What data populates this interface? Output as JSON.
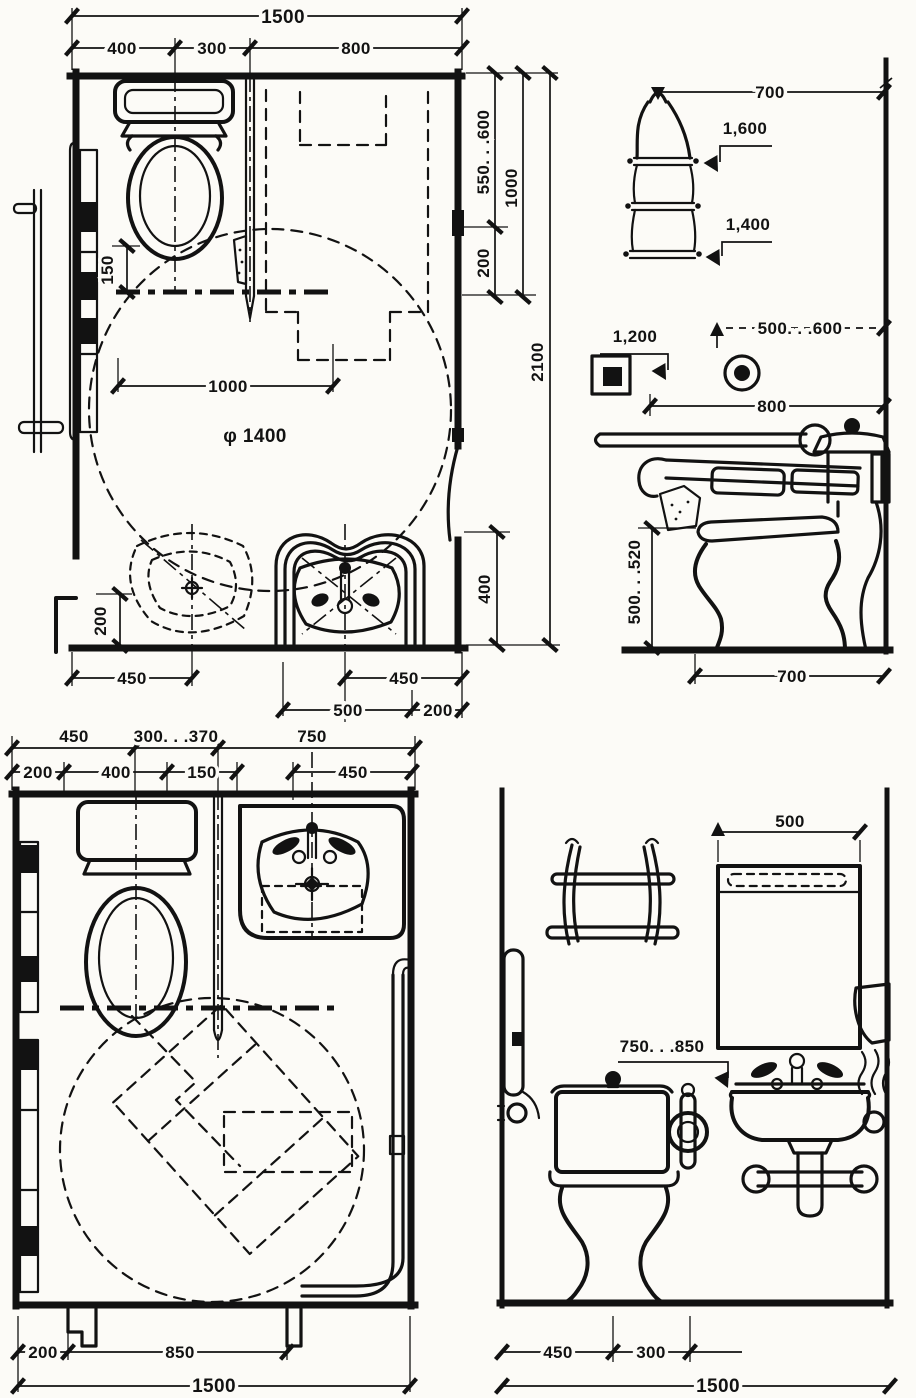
{
  "plan_a": {
    "dims": {
      "total_width": "1500",
      "left": "400",
      "mid": "300",
      "right": "800",
      "grab_offset": "150",
      "reach": "1000",
      "turning_circle": "φ 1400",
      "wall_step": "200",
      "basin_cl": "450",
      "sink_cl": "450",
      "sink_width": "500",
      "sink_edge": "200",
      "side_top": "550. . .600",
      "side_span": "1000",
      "side_low": "200",
      "side_door": "400",
      "total_depth": "2100"
    }
  },
  "elevation_a": {
    "dims": {
      "shelf_width": "700",
      "shelf_top_height": "1,600",
      "shelf_low_height": "1,400",
      "switch_height": "1,200",
      "socket_height": "500. . .600",
      "grab_bar_length": "800",
      "seat_height": "500. . .520",
      "toilet_depth": "700"
    }
  },
  "plan_b": {
    "dims": {
      "row1_left": "450",
      "row1_mid": "300. . .370",
      "row1_right": "750",
      "row2_first": "200",
      "row2_second": "400",
      "row2_third": "150",
      "row2_fourth": "450",
      "bottom_left": "200",
      "door_width": "850",
      "total_width": "1500"
    }
  },
  "elevation_b": {
    "dims": {
      "mirror_width": "500",
      "basin_height": "750. . .850",
      "toilet_cl": "450",
      "holder_offset": "300",
      "total_width": "1500"
    }
  }
}
